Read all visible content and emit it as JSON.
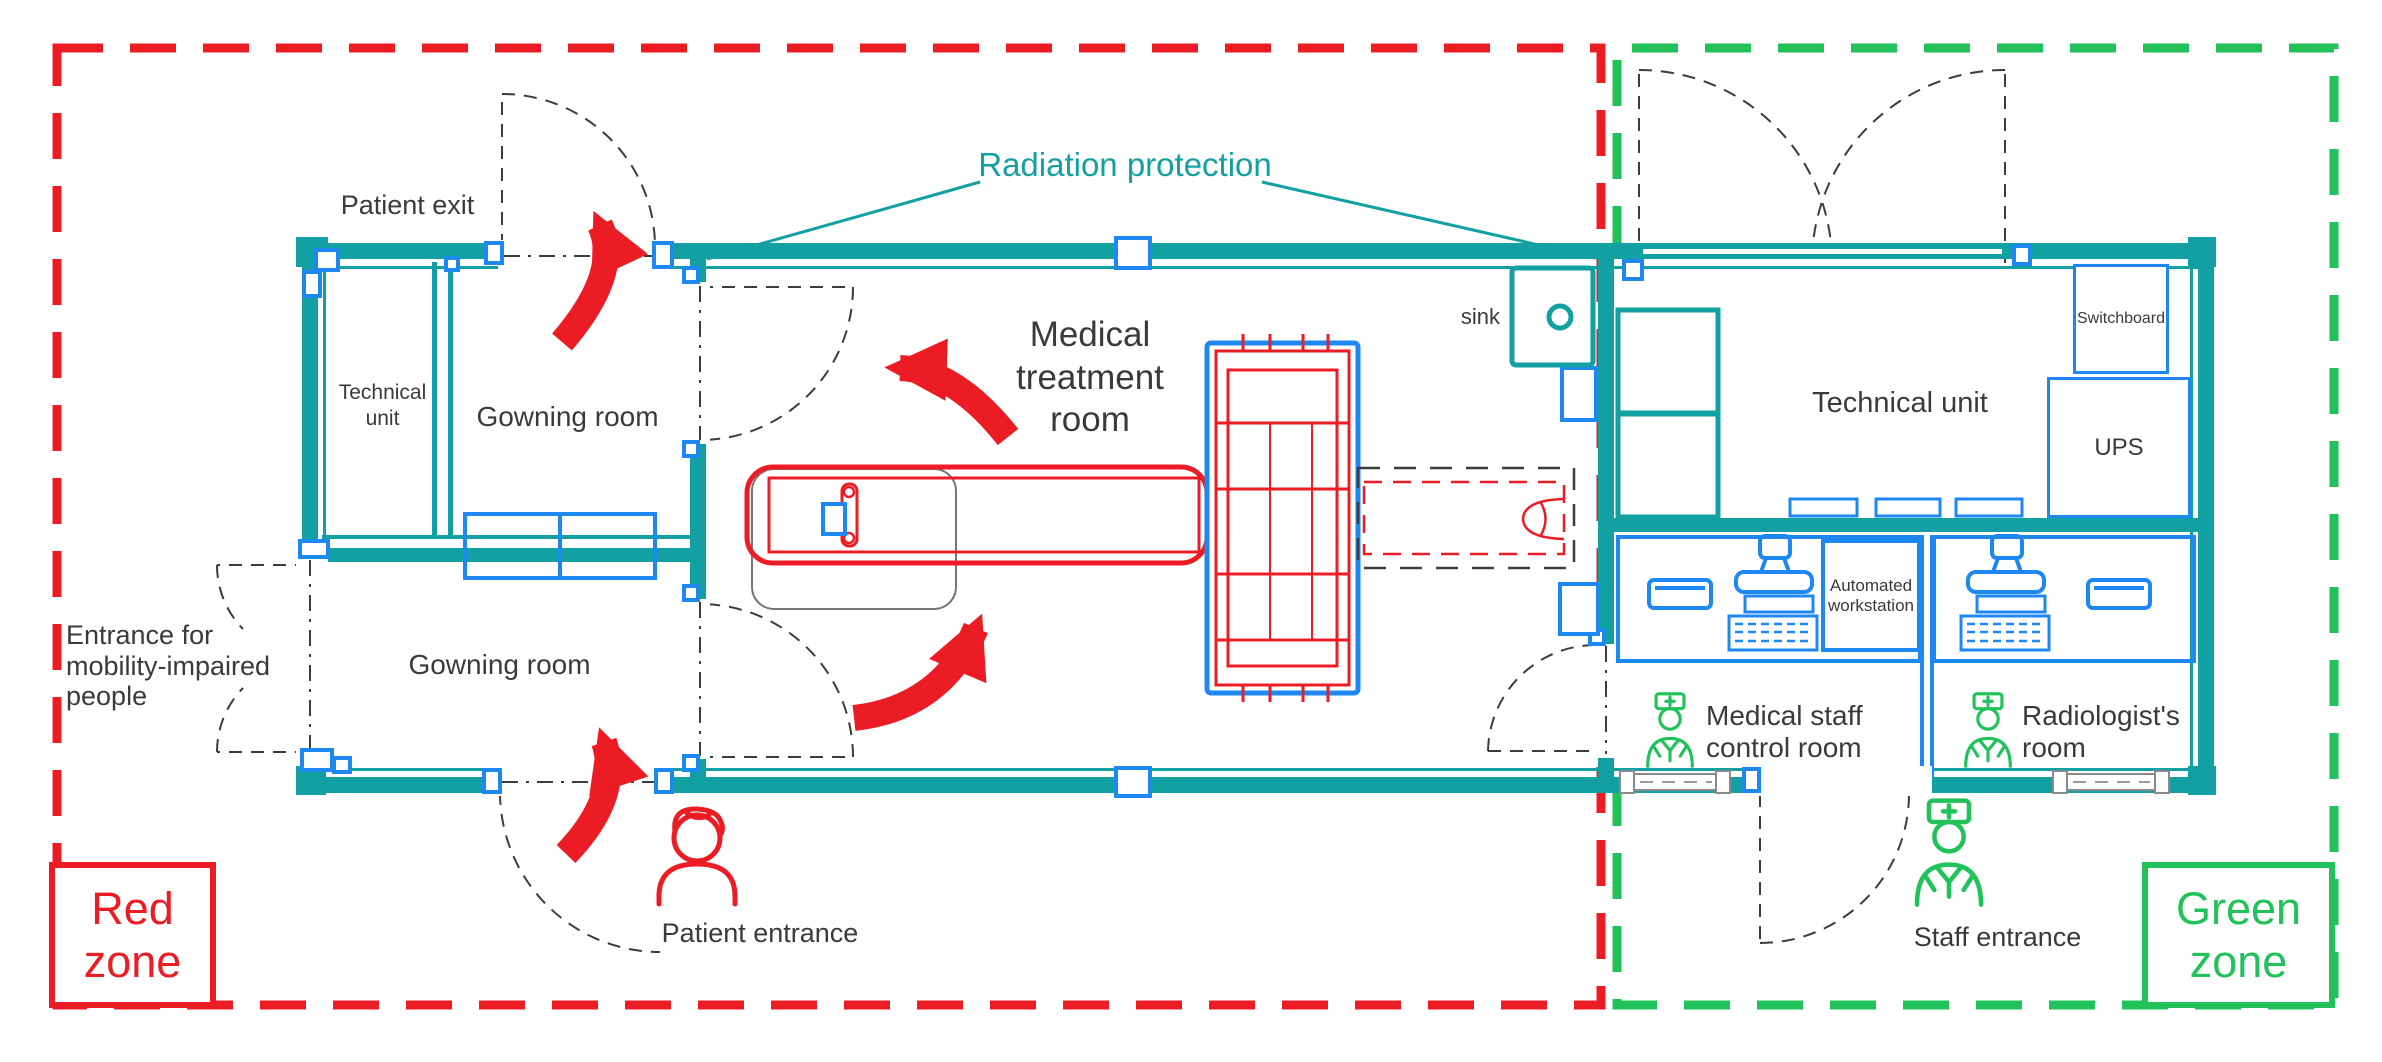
{
  "zones": {
    "red": {
      "label": "Red zone"
    },
    "green": {
      "label": "Green zone"
    }
  },
  "rooms": {
    "technical_unit_left": "Technical unit",
    "gowning_room_upper": "Gowning room",
    "gowning_room_lower": "Gowning room",
    "medical_treatment_room": "Medical treatment room",
    "technical_unit_right": "Technical unit",
    "medical_staff_control_room": "Medical staff control room",
    "radiologists_room": "Radiologist's room"
  },
  "annotations": {
    "patient_exit": "Patient exit",
    "patient_entrance": "Patient entrance",
    "staff_entrance": "Staff entrance",
    "entrance_mobility": "Entrance for mobility-impaired people",
    "radiation_protection": "Radiation protection",
    "sink": "sink"
  },
  "equipment": {
    "switchboard": "Switchboard",
    "ups": "UPS",
    "automated_workstation": "Automated workstation"
  },
  "icons": {
    "patient": "patient-icon",
    "doctor": "doctor-icon"
  },
  "colors": {
    "wall": "#12a0a2",
    "blue": "#1e88f2",
    "red": "#ec1c24",
    "green": "#21c25a",
    "text": "#3a3a3a"
  }
}
